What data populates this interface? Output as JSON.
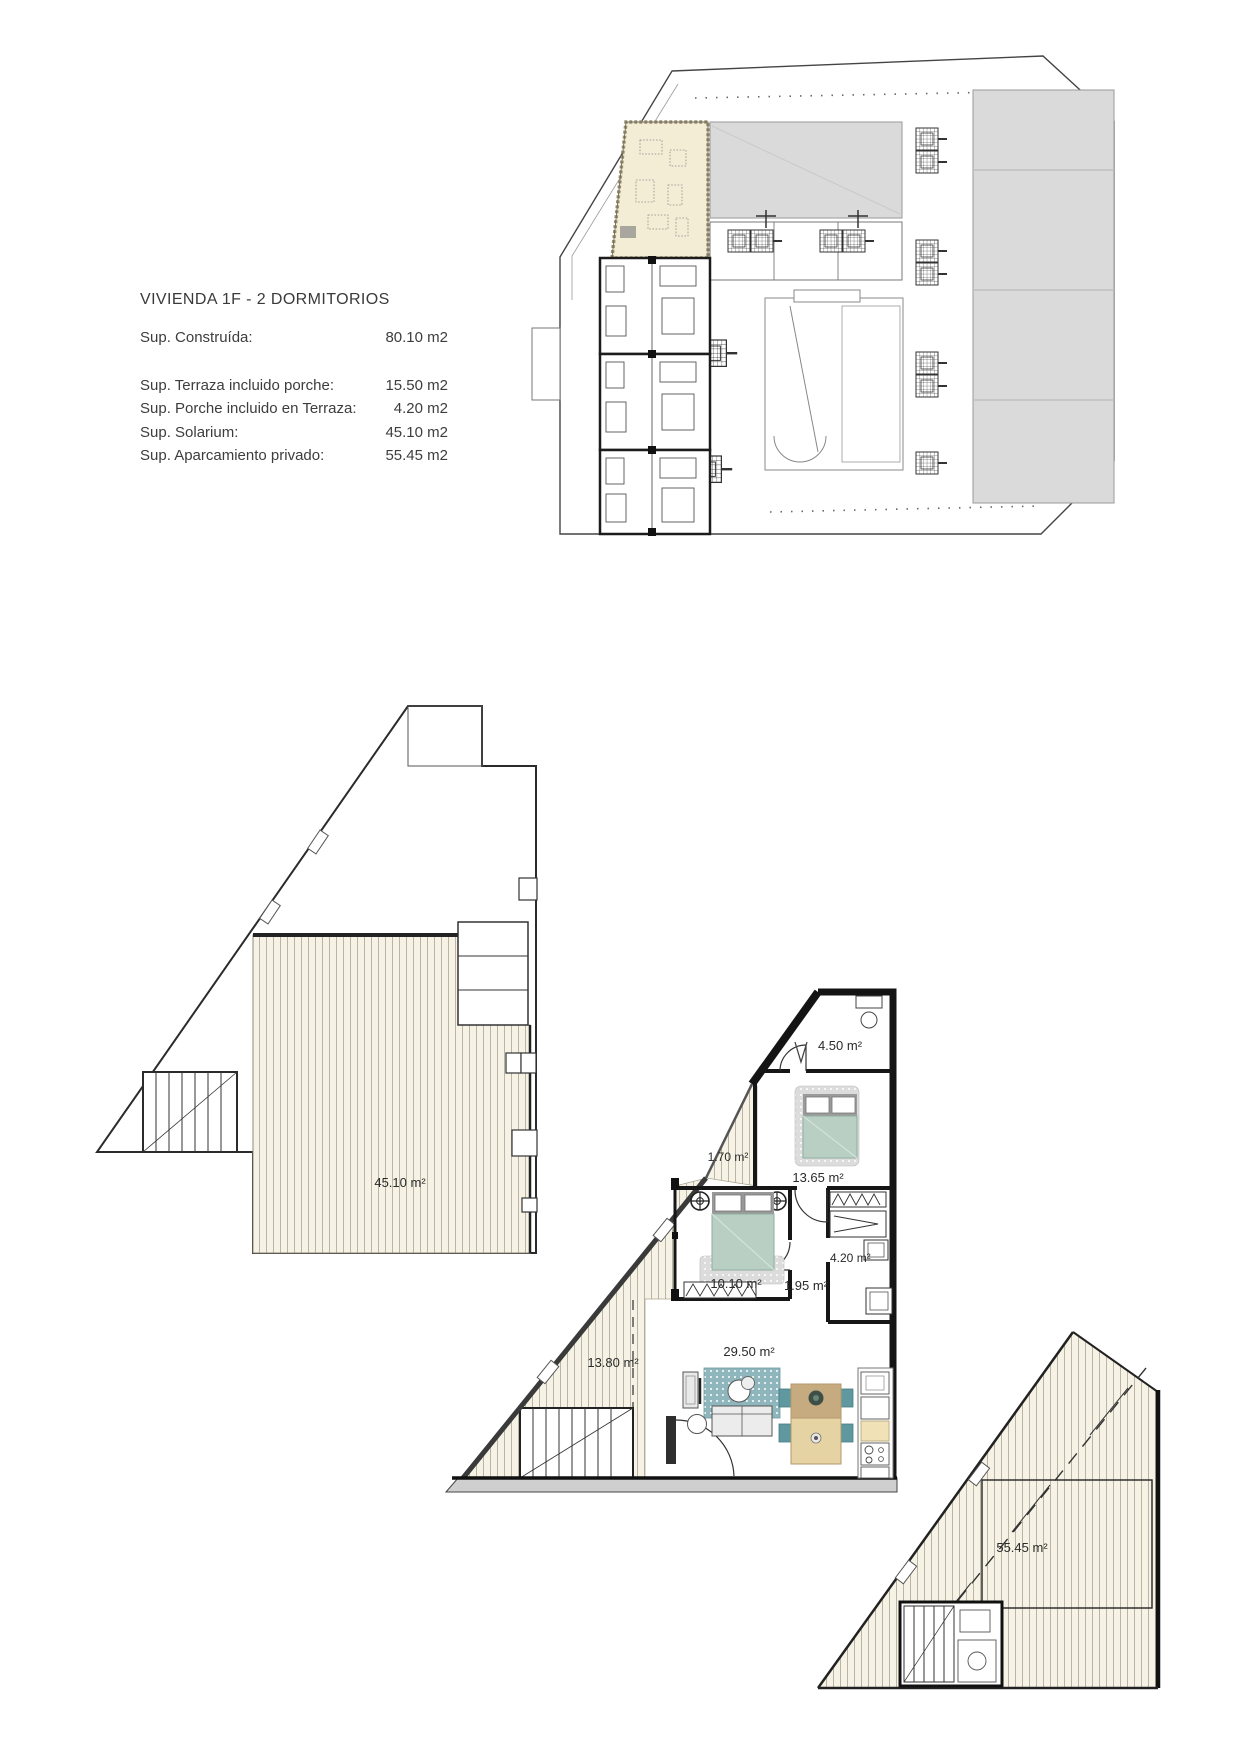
{
  "document": {
    "title": "VIVIENDA  1F - 2 DORMITORIOS",
    "rows": [
      {
        "label": "Sup. Construída:",
        "value": "80.10 m2"
      },
      {
        "label": "Sup. Terraza incluido porche:",
        "value": "15.50 m2"
      },
      {
        "label": "Sup. Porche incluido en Terraza:",
        "value": "4.20 m2"
      },
      {
        "label": "Sup. Solarium:",
        "value": "45.10 m2"
      },
      {
        "label": "Sup. Aparcamiento privado:",
        "value": "55.45 m2"
      }
    ]
  },
  "plans": {
    "solarium": {
      "area": "45.10 m²"
    },
    "apartment": {
      "bath": "4.50 m²",
      "terrace_front": "1.70 m²",
      "bedroom_main": "13.65 m²",
      "closet": "4.20 m²",
      "bedroom_second": "10.10 m²",
      "hall": "1.95 m²",
      "terrace_side": "13.80 m²",
      "living": "29.50 m²"
    },
    "parking": {
      "area": "55.45 m²"
    }
  },
  "colors": {
    "deck_fill": "#f6f3e6",
    "highlight_unit": "#f4edd6",
    "roof_gray": "#dadada",
    "bed_green": "#b9cfc3",
    "chair_teal": "#5f989f",
    "wood": "#c7ab80"
  }
}
